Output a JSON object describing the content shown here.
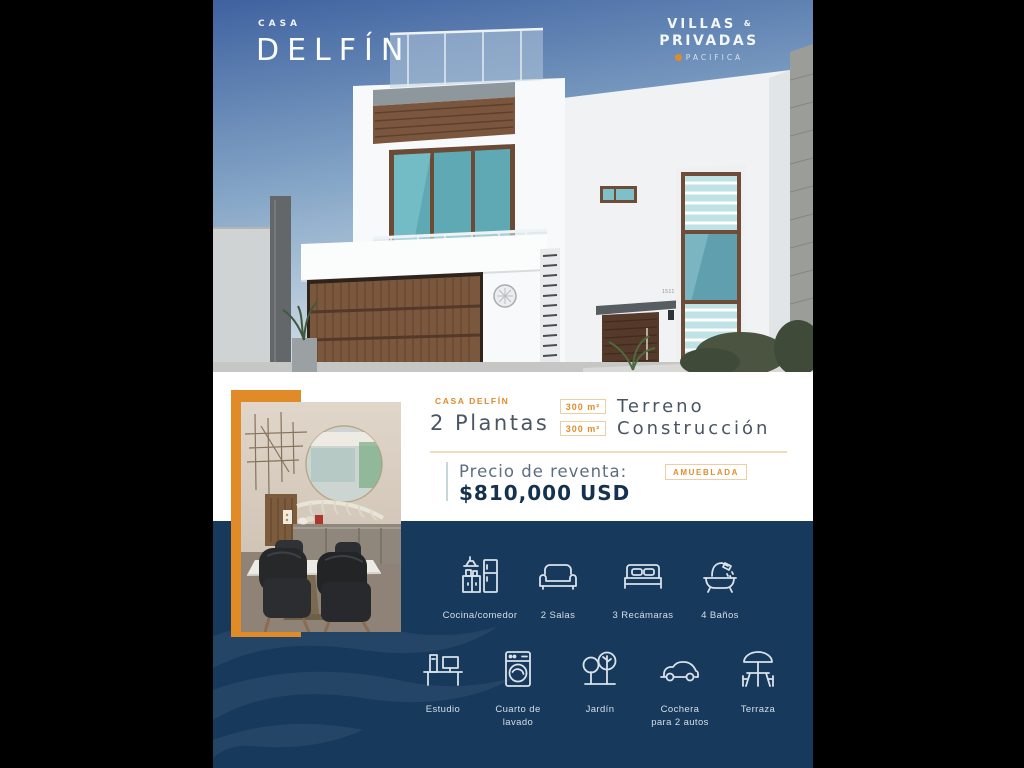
{
  "colors": {
    "accent": "#E08A28",
    "navy": "#173A5C",
    "badge_text": "#DF8E2E",
    "price_navy": "#14324F"
  },
  "header": {
    "eyebrow": "CASA",
    "title": "DELFÍN"
  },
  "brand": {
    "line1": "VILLAS",
    "amp": "&",
    "line2": "PRIVADAS",
    "sub": "PACIFICA"
  },
  "house_photo": {
    "house_number": "1511"
  },
  "info": {
    "project": "CASA DELFÍN",
    "floors": "2 Plantas",
    "lot_badge": "300 m²",
    "lot_label": "Terreno",
    "build_badge": "300 m²",
    "build_label": "Construcción",
    "price_label": "Precio de reventa:",
    "furnished": "AMUEBLADA",
    "price": "$810,000 USD"
  },
  "features": {
    "row1": [
      {
        "icon": "kitchen-icon",
        "label": "Cocina/comedor"
      },
      {
        "icon": "sofa-icon",
        "label": "2 Salas"
      },
      {
        "icon": "bed-icon",
        "label": "3 Recámaras"
      },
      {
        "icon": "bathtub-icon",
        "label": "4 Baños"
      }
    ],
    "row2": [
      {
        "icon": "desk-icon",
        "label": "Estudio"
      },
      {
        "icon": "washer-icon",
        "label": "Cuarto de\nlavado"
      },
      {
        "icon": "trees-icon",
        "label": "Jardín"
      },
      {
        "icon": "car-icon",
        "label": "Cochera\npara 2 autos"
      },
      {
        "icon": "terrace-icon",
        "label": "Terraza"
      }
    ]
  }
}
